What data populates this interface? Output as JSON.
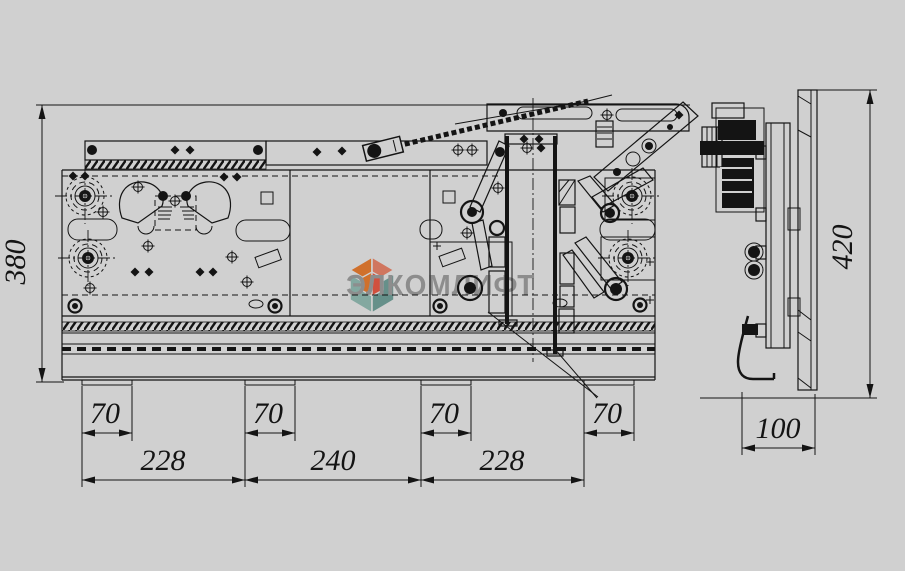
{
  "canvas": {
    "background": "#d0d0d0",
    "line_color": "#141414"
  },
  "watermark": {
    "text": "ЭЛКОМЛИФТ",
    "text_color": "#8d8d8d",
    "logo_colors": {
      "orange": "#e2702c",
      "salmon": "#f2765f",
      "red": "#e3503e",
      "teal_light": "#83a8a0",
      "teal_dark": "#66908a"
    }
  },
  "dimensions": {
    "front_height": "380",
    "side_height": "420",
    "side_width": "100",
    "bracket_1": "70",
    "bracket_2": "70",
    "bracket_3": "70",
    "bracket_4": "70",
    "span_1": "228",
    "span_2": "240",
    "span_3": "228"
  }
}
